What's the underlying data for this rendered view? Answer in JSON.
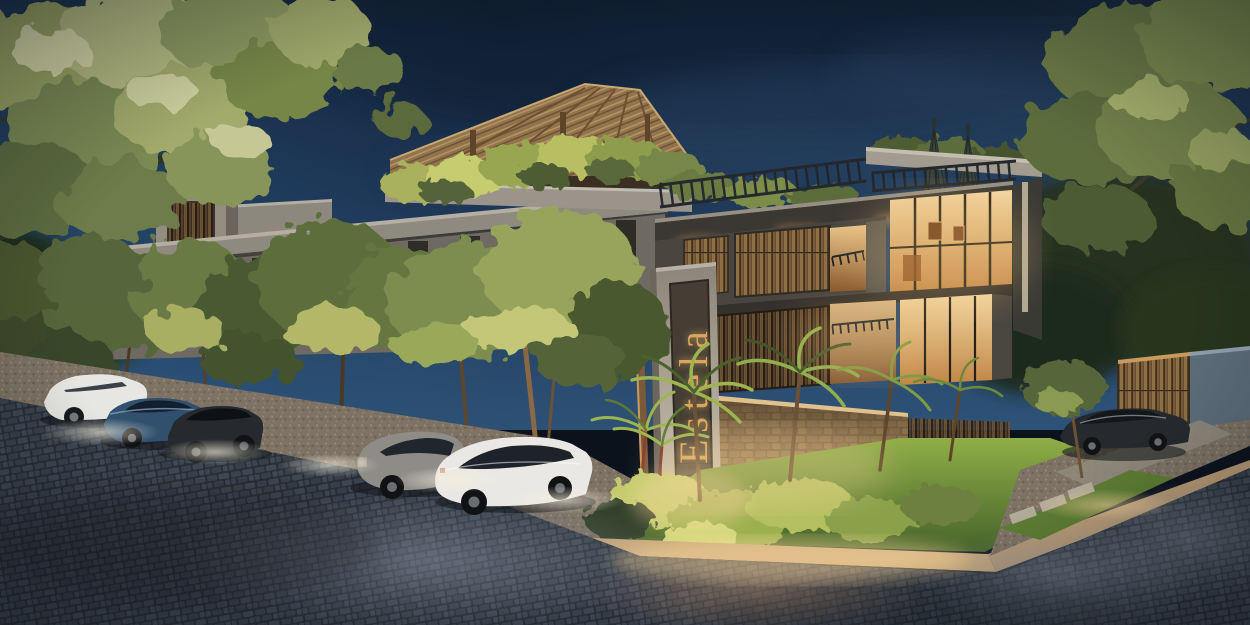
{
  "signage": {
    "name": "Estela"
  },
  "palette": {
    "sky_top": "#121f33",
    "sky_mid": "#1c3453",
    "sky_horizon": "#2d5175",
    "concrete_lit": "#958f84",
    "concrete_shadow": "#57534b",
    "fascia_dark": "#3b3833",
    "thatch_roof": "#97774e",
    "bamboo_wood": "#8a6b42",
    "glass_warm_top": "#f2d7a2",
    "glass_warm_bottom": "#c08545",
    "foliage_lit": "#c9cf8a",
    "foliage_mid": "#74834b",
    "foliage_dark": "#3c4a2c",
    "grass_lit": "#8fae47",
    "grass_dark": "#46632a",
    "stone_wall": "#a3845c",
    "sign_gold": "#d9a65c",
    "sign_panel": "#453e34",
    "street_base": "#2e343d",
    "street_sheen_cool": "#8a95a3",
    "street_sheen_warm": "#c79a78",
    "gravel": "#80755f",
    "sidewalk_pavers": "#c9a87a",
    "umbrella": "#3a433e",
    "fence_wall_blue": "#5d6d7a",
    "car_white": "#e6e6e2",
    "car_blue": "#30506e",
    "car_dark": "#26292d",
    "car_gray": "#8f8c88"
  }
}
